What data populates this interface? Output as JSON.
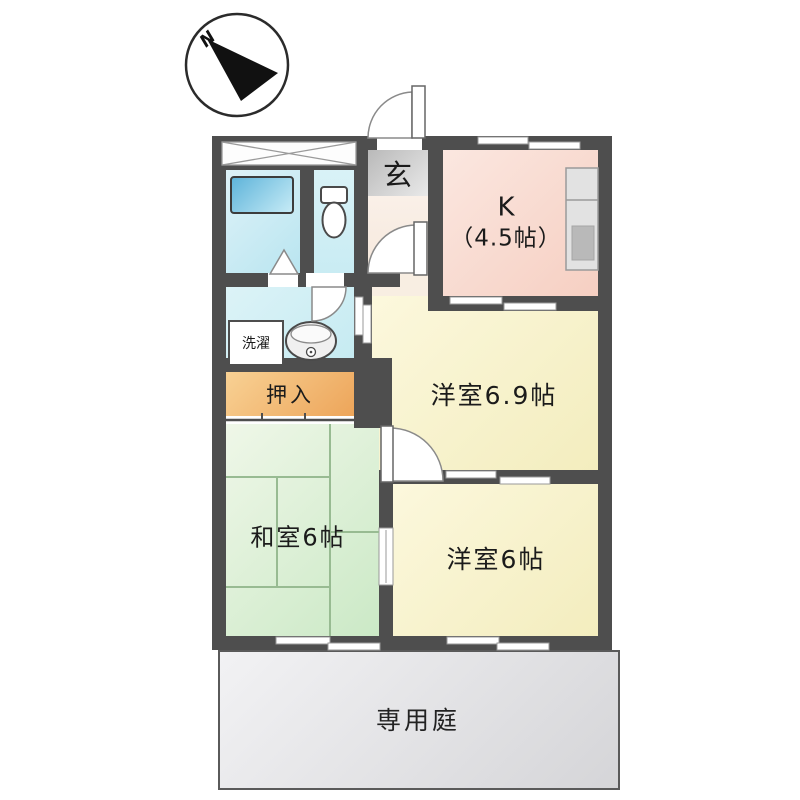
{
  "compass": {
    "north_label": "N"
  },
  "rooms": {
    "entrance": "玄",
    "kitchen_name": "K",
    "kitchen_size": "（4.5帖）",
    "western_69": "洋室6.9帖",
    "western_6": "洋室6帖",
    "japanese_6": "和室6帖",
    "closet": "押入",
    "laundry": "洗濯",
    "private_garden": "専用庭"
  },
  "colors": {
    "wall": "#4e4e4e",
    "bathroom": "#c9e9f3",
    "bathtub": "#6ebede",
    "toilet_room": "#d6f1f6",
    "kitchen": "#f8d5c9",
    "western_room": "#f8f3cc",
    "japanese_room": "#d9eed2",
    "closet": "#f2b56e",
    "entrance_floor": "#f8ecdf",
    "entrance_step": "#cccccc",
    "private_garden": "#e3e3e5"
  }
}
